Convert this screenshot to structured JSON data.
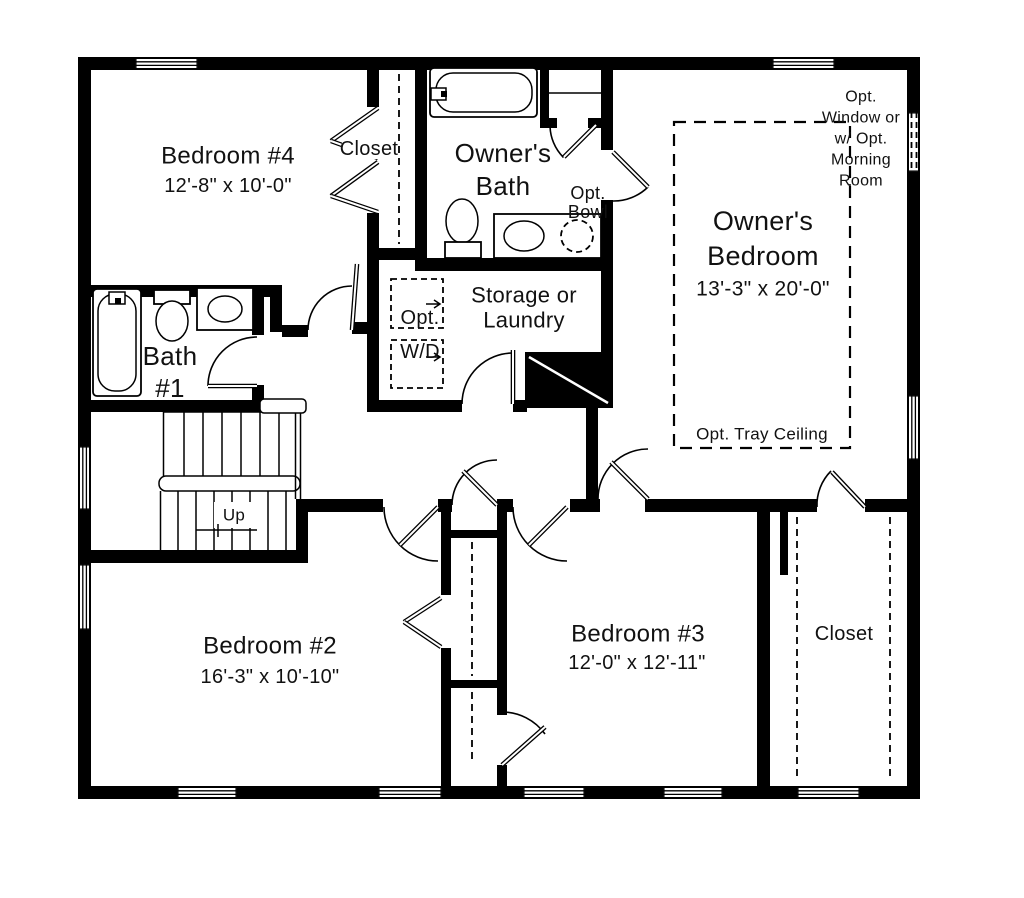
{
  "drawing": {
    "type": "second-floor-plan",
    "colors": {
      "wall": "#000000",
      "background": "#ffffff",
      "text": "#111111"
    },
    "rooms": {
      "bedroom4": {
        "name": "Bedroom #4",
        "dims": "12'-8\" x 10'-0\""
      },
      "bedroom4_closet": {
        "name": "Closet"
      },
      "owners_bath": {
        "line1": "Owner's",
        "line2": "Bath",
        "opt_bowl_line1": "Opt.",
        "opt_bowl_line2": "Bowl"
      },
      "owners_bedroom": {
        "line1": "Owner's",
        "line2": "Bedroom",
        "dims": "13'-3\" x 20'-0\"",
        "tray_note": "Opt. Tray Ceiling",
        "window_note_line1": "Opt.",
        "window_note_line2": "Window or",
        "window_note_line3": "w/ Opt.",
        "window_note_line4": "Morning",
        "window_note_line5": "Room"
      },
      "bath1": {
        "line1": "Bath",
        "line2": "#1"
      },
      "storage_laundry": {
        "line1": "Storage or",
        "line2": "Laundry",
        "opt_wd_line1": "Opt.",
        "opt_wd_line2": "W/D"
      },
      "stairs": {
        "direction": "Up"
      },
      "bedroom2": {
        "name": "Bedroom #2",
        "dims": "16'-3\" x 10'-10\""
      },
      "bedroom3": {
        "name": "Bedroom #3",
        "dims": "12'-0\" x 12'-11\""
      },
      "owners_closet": {
        "name": "Closet"
      }
    }
  }
}
